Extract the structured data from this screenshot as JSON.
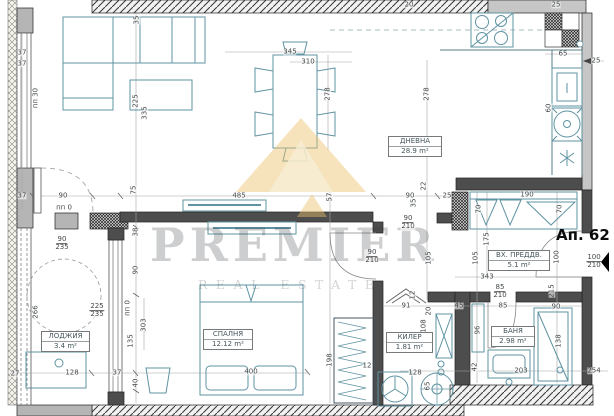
{
  "plan": {
    "apartment_label": "Ап. 62",
    "watermark": {
      "line1": "PREMIER",
      "line2": "REAL ESTATE"
    },
    "rooms": [
      {
        "name": "ДНЕВНА",
        "area": "28.9 m²"
      },
      {
        "name": "СПАЛНЯ",
        "area": "12.12 m²"
      },
      {
        "name": "ЛОДЖИЯ",
        "area": "3.4 m²"
      },
      {
        "name": "КИЛЕР",
        "area": "1.81 m²"
      },
      {
        "name": "БАНЯ",
        "area": "2.98 m²"
      },
      {
        "name": "ВХ. ПРЕДДВ.",
        "area": "5.1 m²"
      }
    ],
    "colors": {
      "wall_dark": "#4d4d4d",
      "wall_light": "#c6c6c6",
      "furniture": "#5f93a2",
      "dimension_text": "#44484a",
      "logo_gold": "#ecc06a"
    },
    "dimensions": [
      {
        "t": "35",
        "x": 137,
        "y": 20,
        "r": -90
      },
      {
        "t": "37",
        "x": 22,
        "y": 53
      },
      {
        "t": "37",
        "x": 22,
        "y": 64
      },
      {
        "t": "пп 30",
        "x": 36,
        "y": 98,
        "r": -90
      },
      {
        "t": "225",
        "x": 136,
        "y": 101,
        "r": -90
      },
      {
        "t": "335",
        "x": 145,
        "y": 113,
        "r": -90
      },
      {
        "t": "75",
        "x": 134,
        "y": 190,
        "r": -90
      },
      {
        "t": "345",
        "x": 290,
        "y": 52
      },
      {
        "t": "310",
        "x": 308,
        "y": 62
      },
      {
        "t": "278",
        "x": 328,
        "y": 94,
        "r": -90
      },
      {
        "t": "278",
        "x": 427,
        "y": 94,
        "r": -90
      },
      {
        "t": "20",
        "x": 409,
        "y": 5
      },
      {
        "t": "25",
        "x": 556,
        "y": 5
      },
      {
        "t": "65",
        "x": 563,
        "y": 54
      },
      {
        "t": "25",
        "x": 596,
        "y": 61
      },
      {
        "t": "60",
        "x": 549,
        "y": 108,
        "r": -90
      },
      {
        "t": "190",
        "x": 527,
        "y": 195
      },
      {
        "t": "70",
        "x": 479,
        "y": 209,
        "r": -90
      },
      {
        "t": "70",
        "x": 560,
        "y": 209,
        "r": -90
      },
      {
        "t": "485",
        "x": 239,
        "y": 196
      },
      {
        "t": "57",
        "x": 330,
        "y": 197,
        "r": -90
      },
      {
        "t": "90",
        "x": 63,
        "y": 196
      },
      {
        "t": "37",
        "x": 22,
        "y": 196
      },
      {
        "t": "пп 0",
        "x": 64,
        "y": 208
      },
      {
        "t": "90",
        "x": 410,
        "y": 196
      },
      {
        "t": "25",
        "x": 447,
        "y": 196
      },
      {
        "t": "22",
        "x": 424,
        "y": 186,
        "r": -90
      },
      {
        "t": "35",
        "x": 414,
        "y": 203,
        "r": -90
      },
      {
        "t": "90/210",
        "x": 408,
        "y": 223,
        "f": 1
      },
      {
        "t": "90/235",
        "x": 62,
        "y": 244,
        "f": 1
      },
      {
        "t": "38",
        "x": 136,
        "y": 232,
        "r": -90
      },
      {
        "t": "90",
        "x": 136,
        "y": 270,
        "r": -90
      },
      {
        "t": "90/210",
        "x": 372,
        "y": 257,
        "f": 1
      },
      {
        "t": "105",
        "x": 429,
        "y": 258,
        "r": -90
      },
      {
        "t": "105",
        "x": 476,
        "y": 258,
        "r": -90
      },
      {
        "t": "175",
        "x": 487,
        "y": 239,
        "r": -90
      },
      {
        "t": "100",
        "x": 557,
        "y": 257,
        "r": -90
      },
      {
        "t": "343",
        "x": 487,
        "y": 277
      },
      {
        "t": "85/210",
        "x": 500,
        "y": 292,
        "f": 1
      },
      {
        "t": "100/210",
        "x": 594,
        "y": 262,
        "f": 1
      },
      {
        "t": "215",
        "x": 552,
        "y": 291,
        "r": -90
      },
      {
        "t": "225/235",
        "x": 97,
        "y": 311,
        "f": 1
      },
      {
        "t": "пп 0",
        "x": 128,
        "y": 308,
        "r": -90
      },
      {
        "t": "266",
        "x": 36,
        "y": 312,
        "r": -90
      },
      {
        "t": "303",
        "x": 144,
        "y": 325,
        "r": -90
      },
      {
        "t": "135",
        "x": 131,
        "y": 341,
        "r": -90
      },
      {
        "t": "40",
        "x": 136,
        "y": 383,
        "r": -90
      },
      {
        "t": "27",
        "x": 15,
        "y": 374
      },
      {
        "t": "128",
        "x": 72,
        "y": 373
      },
      {
        "t": "37",
        "x": 117,
        "y": 373
      },
      {
        "t": "400",
        "x": 251,
        "y": 372
      },
      {
        "t": "198",
        "x": 330,
        "y": 360,
        "r": -90
      },
      {
        "t": "12",
        "x": 367,
        "y": 366
      },
      {
        "t": "91",
        "x": 406,
        "y": 306
      },
      {
        "t": "20",
        "x": 429,
        "y": 311,
        "r": -90
      },
      {
        "t": "45",
        "x": 459,
        "y": 306
      },
      {
        "t": "85",
        "x": 503,
        "y": 306
      },
      {
        "t": "90",
        "x": 556,
        "y": 307
      },
      {
        "t": "12",
        "x": 413,
        "y": 295,
        "r": -90
      },
      {
        "t": "108",
        "x": 424,
        "y": 326,
        "r": -90
      },
      {
        "t": "96",
        "x": 478,
        "y": 330,
        "r": -90
      },
      {
        "t": "42",
        "x": 475,
        "y": 367,
        "r": -90
      },
      {
        "t": "65",
        "x": 428,
        "y": 386,
        "r": -90
      },
      {
        "t": "128",
        "x": 415,
        "y": 373
      },
      {
        "t": "203",
        "x": 521,
        "y": 371
      },
      {
        "t": "254",
        "x": 594,
        "y": 371
      },
      {
        "t": "138",
        "x": 559,
        "y": 341,
        "r": -90
      }
    ]
  }
}
